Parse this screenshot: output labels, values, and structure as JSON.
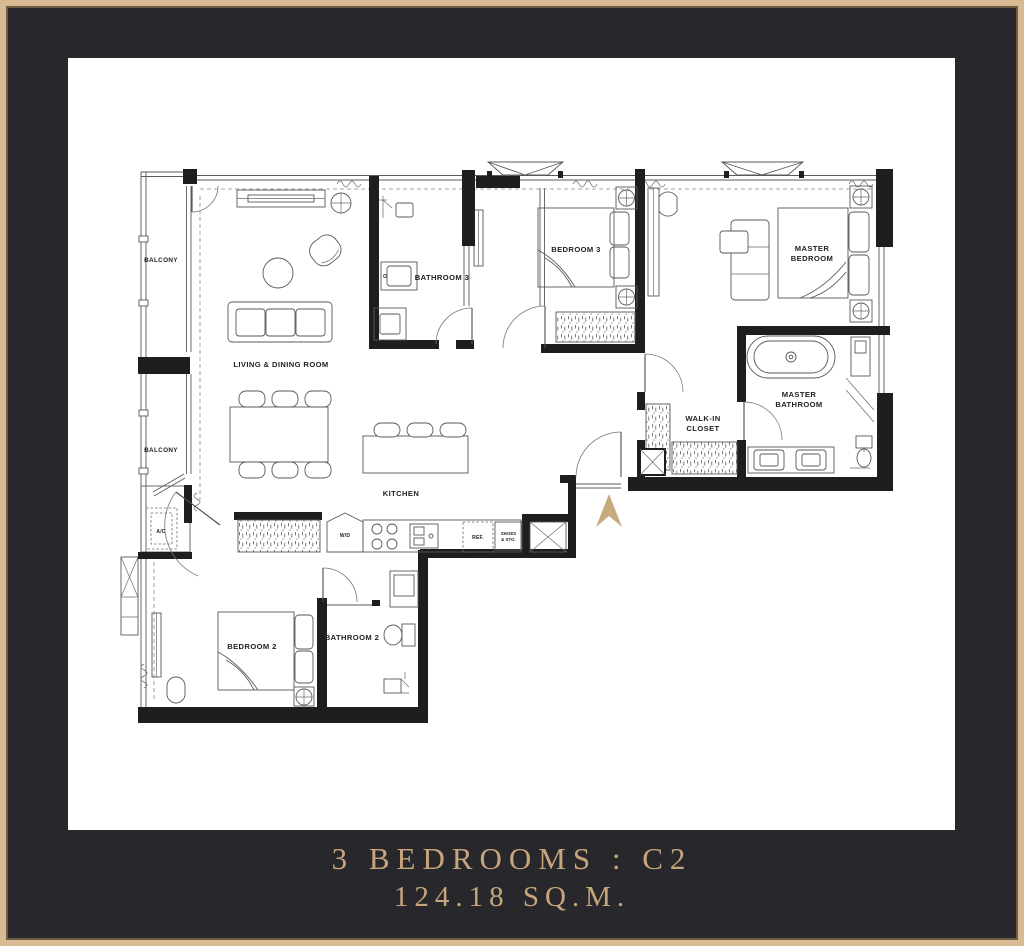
{
  "frame": {
    "background_color": "#28282c",
    "border_gold": "#d9ba92",
    "panel_color": "#ffffff"
  },
  "caption": {
    "unit_type": "3 BEDROOMS : C2",
    "area": "124.18 SQ.M.",
    "text_color": "#c6a57c"
  },
  "plan": {
    "accent_gold": "#c9a97e",
    "labels": {
      "balcony1": "BALCONY",
      "balcony2": "BALCONY",
      "living_dining": "LIVING & DINING ROOM",
      "kitchen": "KITCHEN",
      "bathroom3": "BATHROOM 3",
      "bedroom3": "BEDROOM 3",
      "master_bed_l1": "MASTER",
      "master_bed_l2": "BEDROOM",
      "master_bath_l1": "MASTER",
      "master_bath_l2": "BATHROOM",
      "wic_l1": "WALK-IN",
      "wic_l2": "CLOSET",
      "bedroom2": "BEDROOM 2",
      "bathroom2": "BATHROOM 2",
      "ac": "A/C",
      "wd": "W/D",
      "ref": "REF.",
      "shoes_l1": "SHOES",
      "shoes_l2": "& STO."
    }
  }
}
